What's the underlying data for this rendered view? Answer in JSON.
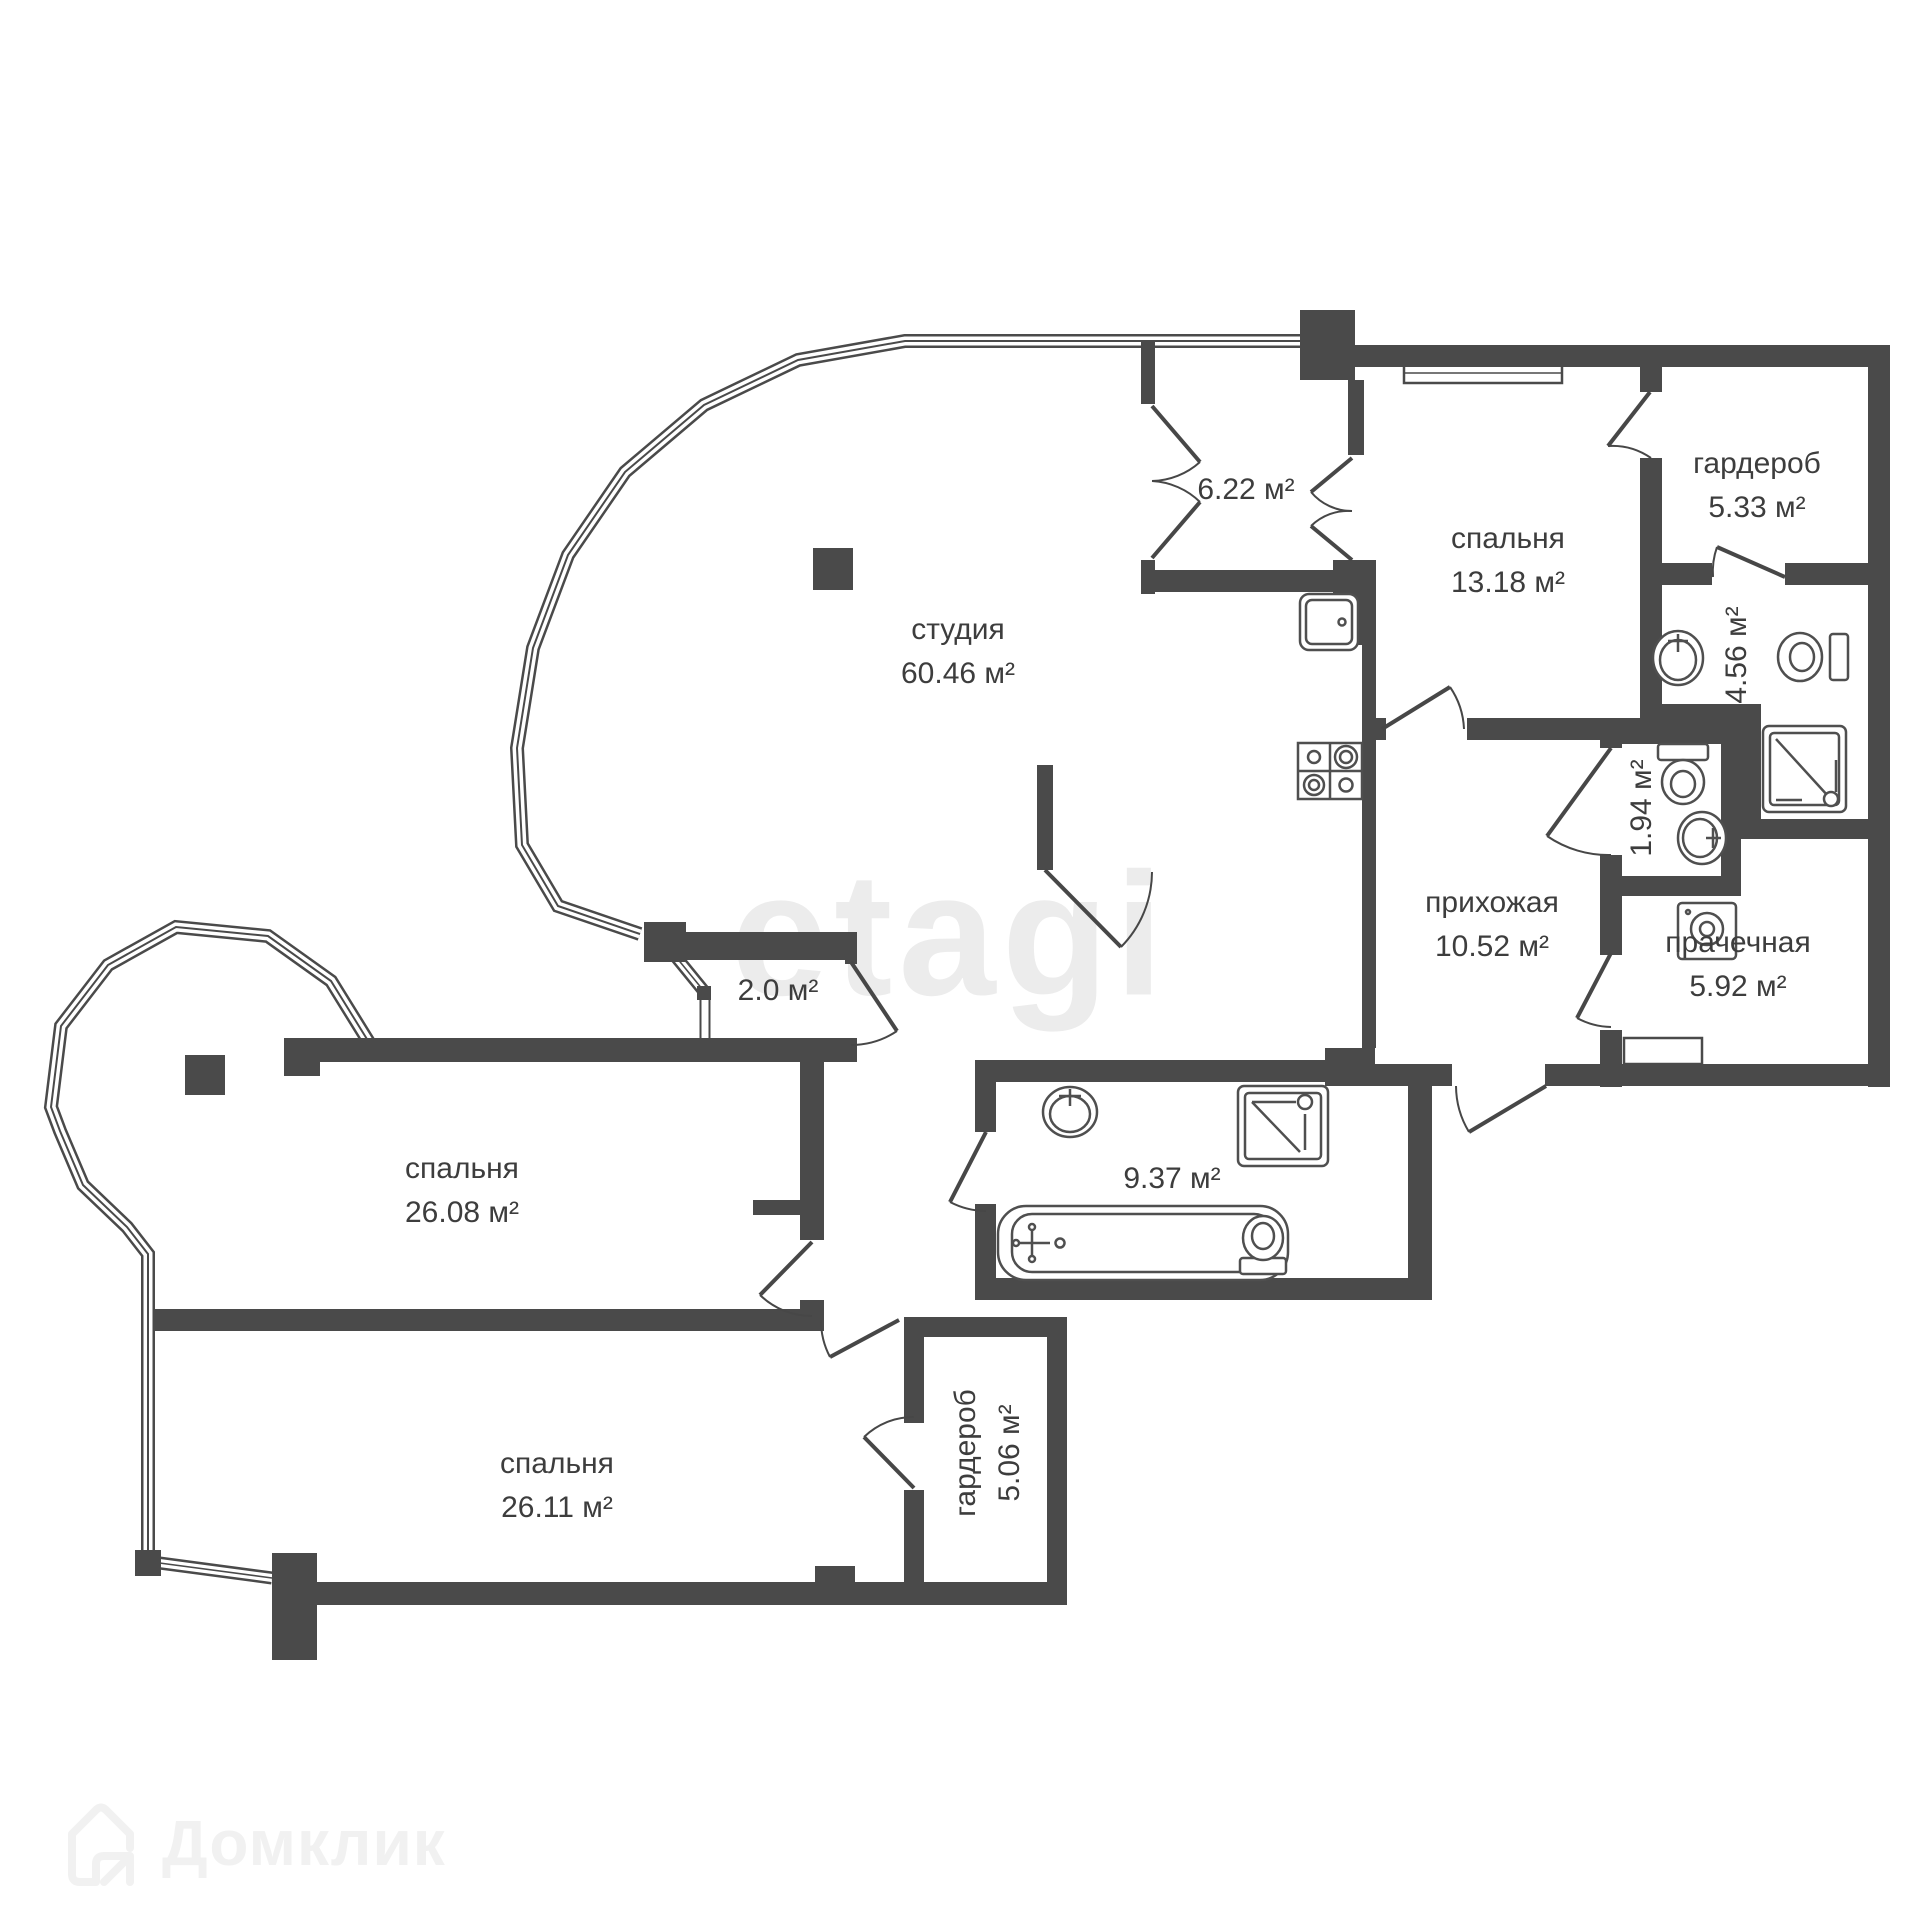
{
  "watermark": {
    "text": "etagi"
  },
  "brand": {
    "logo_text": "Домклик"
  },
  "rooms": {
    "studio": {
      "name": "студия",
      "area": "60.46 м²"
    },
    "balcony_top": {
      "area": "6.22 м²"
    },
    "bedroom_top_right": {
      "name": "спальня",
      "area": "13.18 м²"
    },
    "wardrobe_top": {
      "name": "гардероб",
      "area": "5.33 м²"
    },
    "bathroom_small": {
      "area": "4.56 м²"
    },
    "wc": {
      "area": "1.94 м²"
    },
    "hallway": {
      "name": "прихожая",
      "area": "10.52 м²"
    },
    "laundry": {
      "name": "прачечная",
      "area": "5.92 м²"
    },
    "balcony_small": {
      "area": "2.0 м²"
    },
    "bedroom_left": {
      "name": "спальня",
      "area": "26.08 м²"
    },
    "bedroom_bottom": {
      "name": "спальня",
      "area": "26.11 м²"
    },
    "wardrobe_bottom": {
      "name": "гардероб",
      "area": "5.06 м²"
    },
    "bathroom_main": {
      "area": "9.37 м²"
    }
  }
}
